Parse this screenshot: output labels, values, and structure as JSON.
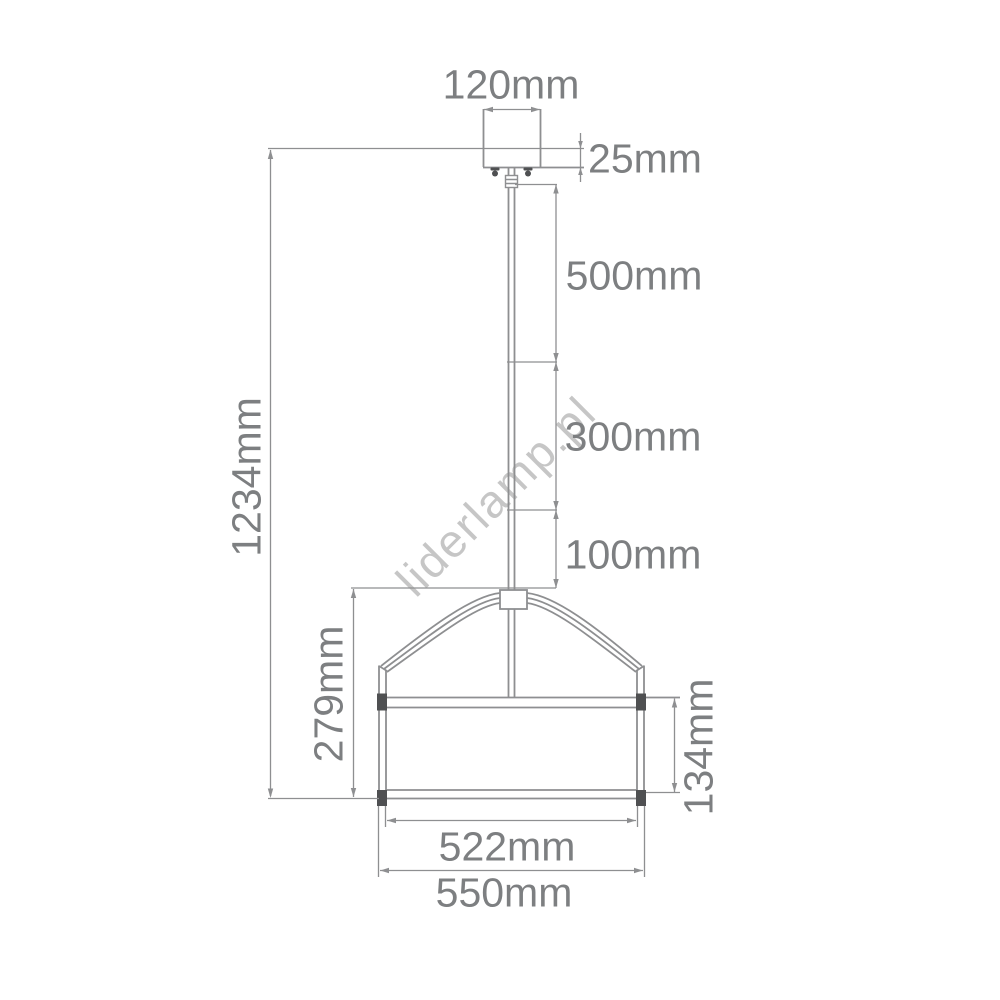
{
  "title": "Pendant lamp technical dimension drawing",
  "watermark": "liderlamp.pl",
  "dimensions": {
    "canopy_width": "120mm",
    "canopy_height": "25mm",
    "rod_segment_upper": "500mm",
    "rod_segment_middle": "300mm",
    "rod_segment_lower": "100mm",
    "total_height": "1234mm",
    "shade_total_height": "279mm",
    "shade_drum_height": "134mm",
    "shade_inner_diameter": "522mm",
    "shade_outer_diameter": "550mm"
  },
  "colors": {
    "background": "#ffffff",
    "line": "#8e8f91",
    "dark": "#4f5052",
    "dim_text": "#7d7f81",
    "watermark": "#c6c6c6"
  }
}
